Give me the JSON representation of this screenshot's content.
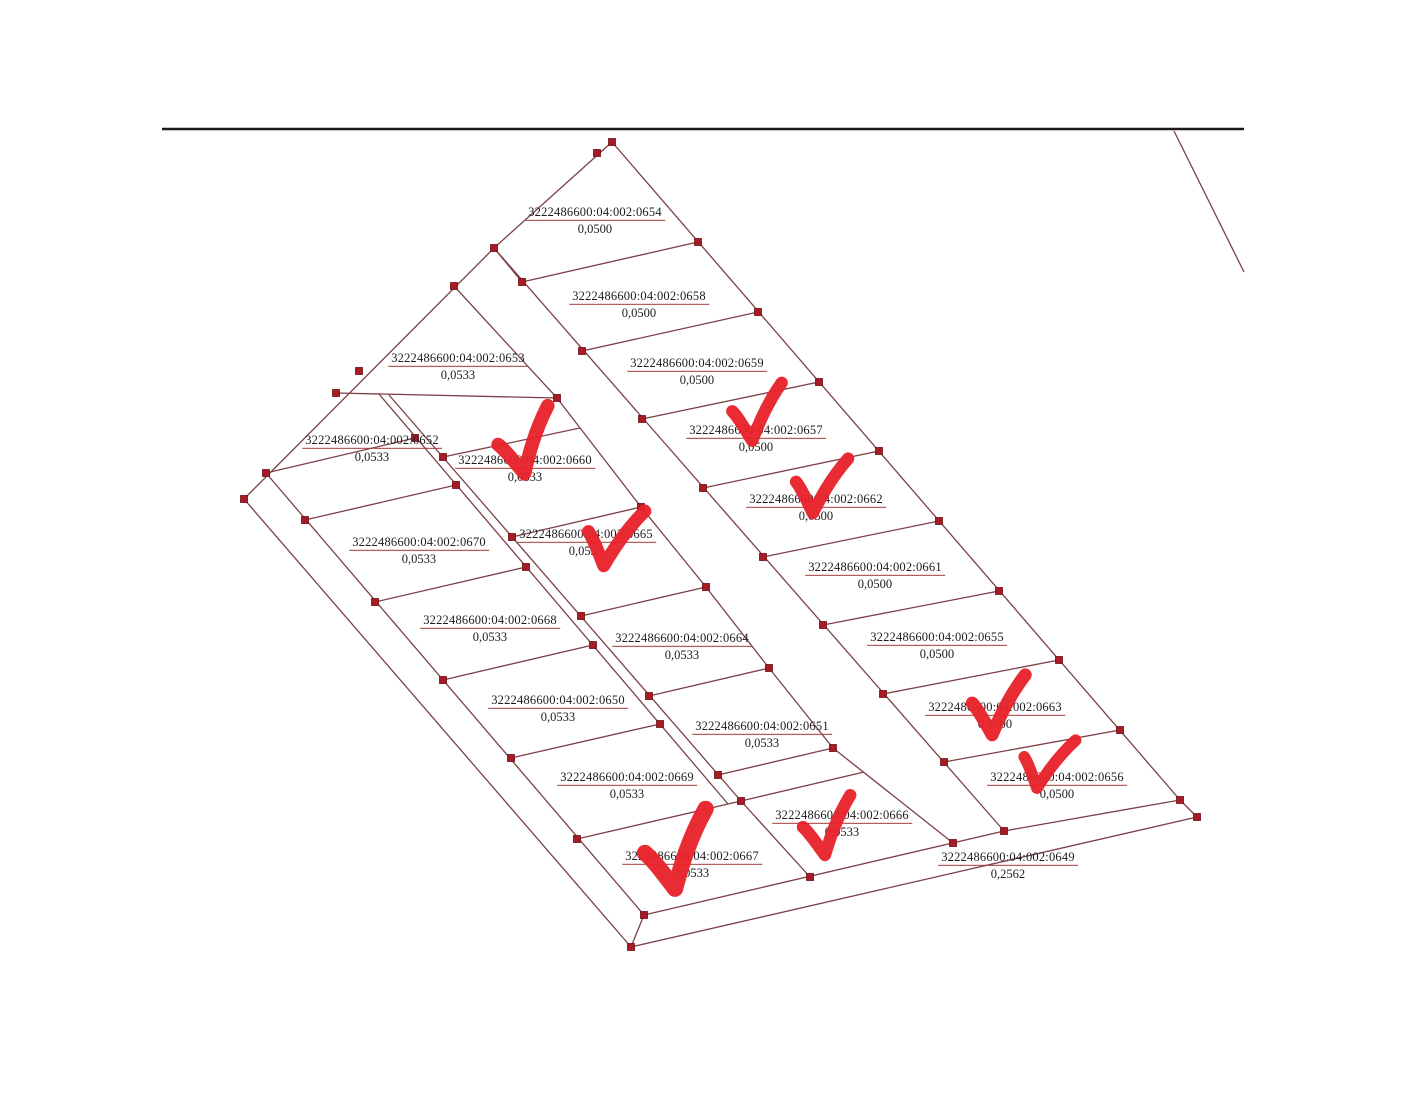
{
  "map": {
    "description_labels": {
      "cadastral_prefix": "3222486600:04:002:"
    },
    "colors": {
      "boundary_line": "#7b4046",
      "vertex_marker": "#a61b24",
      "vertex_edge": "#6d1016",
      "fraction_bar": "#a33a3a",
      "checkmark": "#e8222b",
      "frame_line": "#1a1a1a",
      "text": "#1c1c1c",
      "background": "#ffffff"
    },
    "parcels": [
      {
        "code": "0654",
        "number": "3222486600:04:002:0654",
        "area": "0,0500",
        "checked": false
      },
      {
        "code": "0658",
        "number": "3222486600:04:002:0658",
        "area": "0,0500",
        "checked": false
      },
      {
        "code": "0659",
        "number": "3222486600:04:002:0659",
        "area": "0,0500",
        "checked": false
      },
      {
        "code": "0657",
        "number": "3222486600:04:002:0657",
        "area": "0,0500",
        "checked": true
      },
      {
        "code": "0662",
        "number": "3222486600:04:002:0662",
        "area": "0,0500",
        "checked": true
      },
      {
        "code": "0661",
        "number": "3222486600:04:002:0661",
        "area": "0,0500",
        "checked": false
      },
      {
        "code": "0655",
        "number": "3222486600:04:002:0655",
        "area": "0,0500",
        "checked": false
      },
      {
        "code": "0663",
        "number": "3222486600:04:002:0663",
        "area": "0,0500",
        "checked": true
      },
      {
        "code": "0656",
        "number": "3222486600:04:002:0656",
        "area": "0,0500",
        "checked": true
      },
      {
        "code": "0649",
        "number": "3222486600:04:002:0649",
        "area": "0,2562",
        "checked": false
      },
      {
        "code": "0653",
        "number": "3222486600:04:002:0653",
        "area": "0,0533",
        "checked": false
      },
      {
        "code": "0652",
        "number": "3222486600:04:002:0652",
        "area": "0,0533",
        "checked": false
      },
      {
        "code": "0660",
        "number": "3222486600:04:002:0660",
        "area": "0,0533",
        "checked": true
      },
      {
        "code": "0670",
        "number": "3222486600:04:002:0670",
        "area": "0,0533",
        "checked": false
      },
      {
        "code": "0665",
        "number": "3222486600:04:002:0665",
        "area": "0,0533",
        "checked": true
      },
      {
        "code": "0668",
        "number": "3222486600:04:002:0668",
        "area": "0,0533",
        "checked": false
      },
      {
        "code": "0664",
        "number": "3222486600:04:002:0664",
        "area": "0,0533",
        "checked": false
      },
      {
        "code": "0650",
        "number": "3222486600:04:002:0650",
        "area": "0,0533",
        "checked": false
      },
      {
        "code": "0651",
        "number": "3222486600:04:002:0651",
        "area": "0,0533",
        "checked": false
      },
      {
        "code": "0669",
        "number": "3222486600:04:002:0669",
        "area": "0,0533",
        "checked": false
      },
      {
        "code": "0666",
        "number": "3222486600:04:002:0666",
        "area": "0,0533",
        "checked": true
      },
      {
        "code": "0667",
        "number": "3222486600:04:002:0667",
        "area": "0,0533",
        "checked": true
      }
    ]
  }
}
